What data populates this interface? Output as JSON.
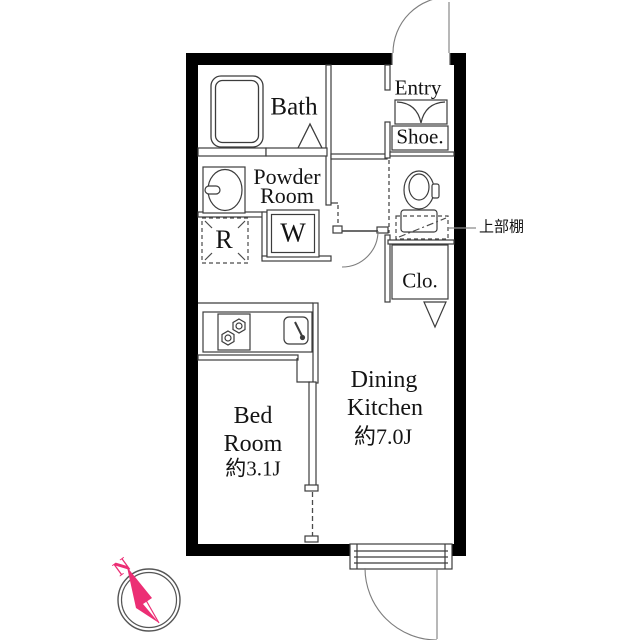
{
  "rooms": {
    "bath": {
      "label": "Bath"
    },
    "powder_room": {
      "label": "Powder Room",
      "lines": [
        "Powder",
        "Room"
      ]
    },
    "refrigerator_space": {
      "label": "R"
    },
    "washing_machine": {
      "label": "W"
    },
    "entry": {
      "label": "Entry"
    },
    "shoe_cabinet": {
      "label": "Shoe."
    },
    "closet": {
      "label": "Clo."
    },
    "dining_kitchen": {
      "label": "Dining Kitchen",
      "lines": [
        "Dining",
        "Kitchen"
      ],
      "size": "約7.0J"
    },
    "bed_room": {
      "label": "Bed Room",
      "lines": [
        "Bed",
        "Room"
      ],
      "size": "約3.1J"
    }
  },
  "annotations": {
    "upper_shelf_label": "上部棚"
  },
  "compass": {
    "north_label": "N"
  },
  "colors": {
    "wall": "#000000",
    "thin_line": "#3c3c3c",
    "door_arc": "#7d7d7d",
    "compass_pink": "#ec2e74",
    "leader_line": "#8a8a8a",
    "background": "#ffffff"
  }
}
